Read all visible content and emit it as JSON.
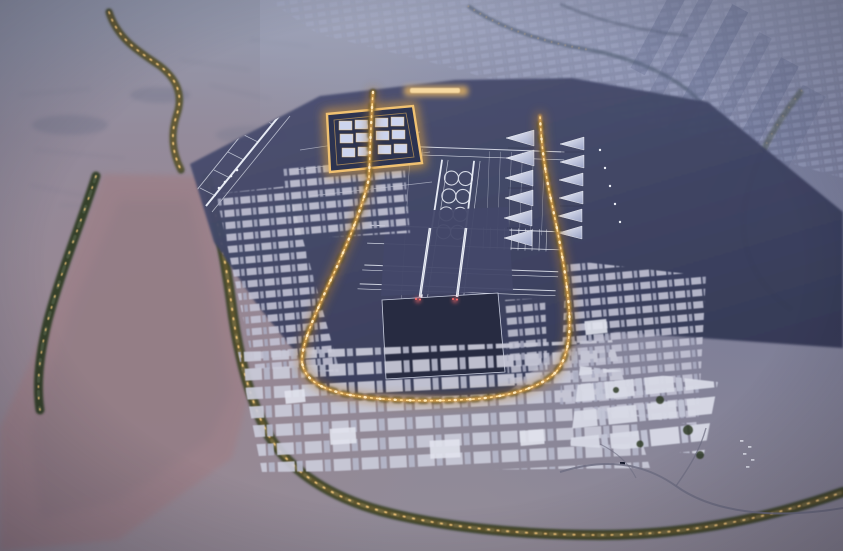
{
  "scene": {
    "type": "aerial-dusk-render",
    "description": "Aerial dusk rendering of a vast planned airport-city in the desert: an illuminated terminal spine, a grid of white runways and taxiways, a glowing golden boulevard loop lined with trees, dense low-rise blocks, a pink wadi valley with green belts to the west and hazy city lights on the horizon.",
    "time_of_day": "dusk",
    "width": 843,
    "height": 551
  },
  "palette": {
    "desert": "#8d8a9b",
    "desert_pink": "#9c8088",
    "distant_blue": "#6b7397",
    "platform": "#474c6b",
    "platform_dark": "#353a56",
    "runway_line": "#e6eaf4",
    "pad_dark": "#262a40",
    "block_roof": "#c6c7d6",
    "warehouse_roof": "#d8dae6",
    "gold_glow": "#e6a94f",
    "gold_bright": "#ffd98f",
    "vegetation": "#36412c",
    "red_light": "#ff6b6b"
  },
  "regions": [
    {
      "name": "desert-plain",
      "label": "Twilight desert plain"
    },
    {
      "name": "distant-city",
      "label": "Hazy city lights on the horizon"
    },
    {
      "name": "farmland",
      "label": "Dark field patches to the north-east"
    },
    {
      "name": "wadi-valley",
      "label": "Winding pink wadi valley"
    },
    {
      "name": "vegetation-belt",
      "label": "Tree-lined green belt with golden lighting"
    },
    {
      "name": "airport-platform",
      "label": "Dark airfield platform"
    },
    {
      "name": "runway-grid",
      "label": "White runway and taxiway grid"
    },
    {
      "name": "terminal-complex",
      "label": "Illuminated sail-roof terminal concourses"
    },
    {
      "name": "gateway-square",
      "label": "Glowing square gateway complex"
    },
    {
      "name": "boulevard-loop",
      "label": "Golden illuminated boulevard loop"
    },
    {
      "name": "central-pads",
      "label": "Large central development pads"
    },
    {
      "name": "short-runways",
      "label": "Central runways with red approach lights"
    },
    {
      "name": "city-blocks",
      "label": "Low-rise district blocks"
    },
    {
      "name": "warehouse-district",
      "label": "Logistics warehouse district"
    },
    {
      "name": "access-roads",
      "label": "Desert access roads"
    },
    {
      "name": "north-glow",
      "label": "Lit northern esplanade"
    }
  ]
}
